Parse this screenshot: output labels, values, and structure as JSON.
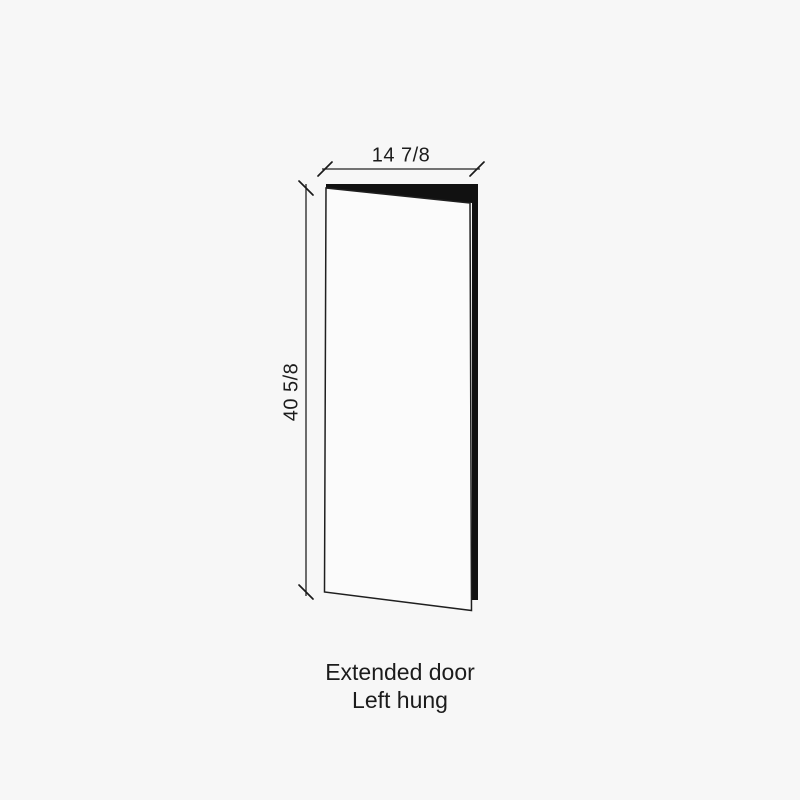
{
  "canvas": {
    "background_color": "#f7f7f7",
    "ink_color": "#1c1c1c"
  },
  "diagram": {
    "width_dimension_label": "14 7/8",
    "height_dimension_label": "40 5/8",
    "caption_line1": "Extended door",
    "caption_line2": "Left hung"
  },
  "drawing": {
    "edge_fill_color": "#111111",
    "front_face_fill_color": "#fbfbfb",
    "door_edge_path": "M326,184 L478,184 L478,600 L472,600 L472,203 L326,189 Z",
    "door_front_path": "M326,188 L470,203 L471.5,610.5 L324.5,592 Z",
    "width_dim_line_path": "M322,169 L480,169",
    "width_tick_left_path": "M318,176 L332,162",
    "width_tick_right_path": "M470,176 L484,162",
    "height_dim_line_path": "M306,184 L306,596",
    "height_tick_top_path": "M299,181 L313,195",
    "height_tick_bottom_path": "M299,585 L313,599"
  }
}
